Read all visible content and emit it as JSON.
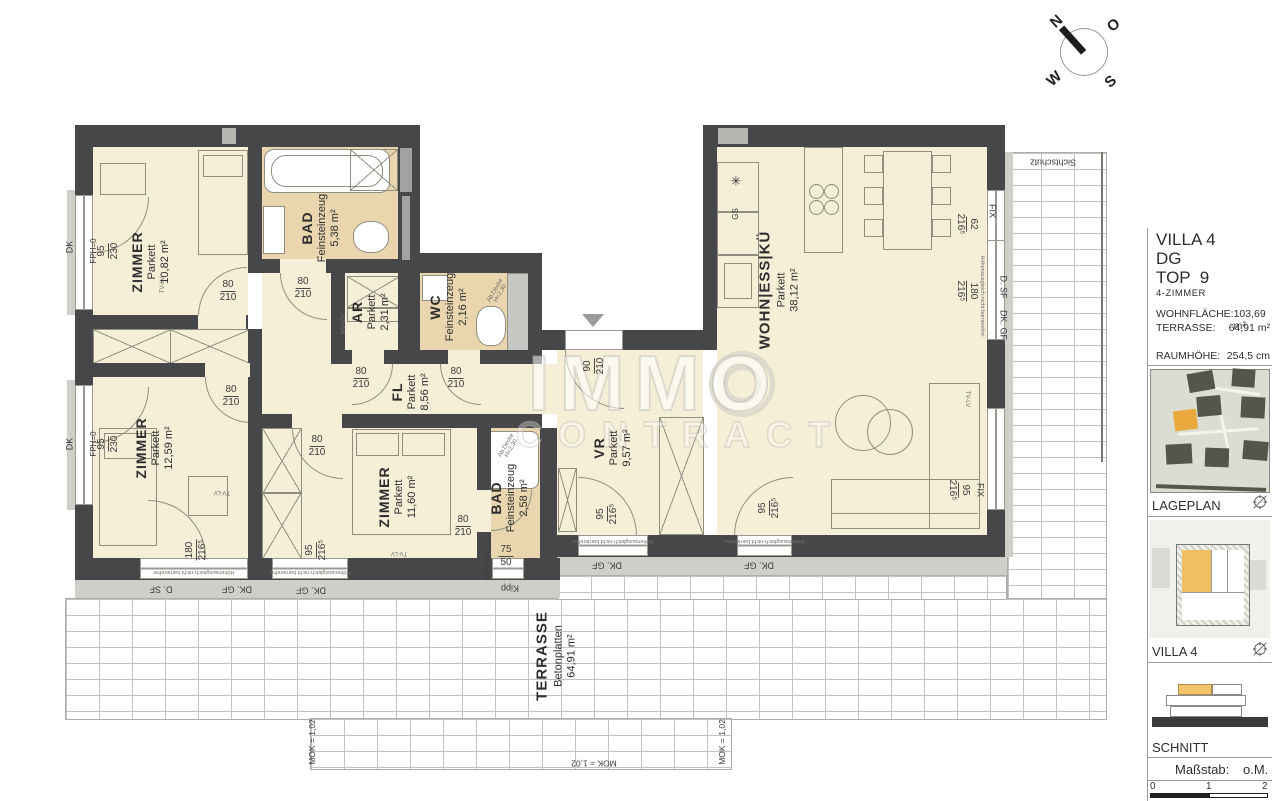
{
  "compass": {
    "n": "N",
    "e": "O",
    "s": "S",
    "w": "W"
  },
  "watermark": {
    "line1": "IMMO",
    "line2": "CONTRACT"
  },
  "rooms": {
    "zimmer1": {
      "name": "ZIMMER",
      "floor": "Parkett",
      "area": "10,82 m²"
    },
    "bad1": {
      "name": "BAD",
      "floor": "Feinsteinzeug",
      "area": "5,38 m²"
    },
    "ar": {
      "name": "AR",
      "floor": "Parkett",
      "area": "2,31 m²"
    },
    "wc": {
      "name": "WC",
      "floor": "Feinsteinzeug",
      "area": "2,16 m²"
    },
    "fl": {
      "name": "FL",
      "floor": "Parkett",
      "area": "8,56 m²"
    },
    "zimmer2": {
      "name": "ZIMMER",
      "floor": "Parkett",
      "area": "12,59 m²"
    },
    "zimmer3": {
      "name": "ZIMMER",
      "floor": "Parkett",
      "area": "11,60 m²"
    },
    "bad2": {
      "name": "BAD",
      "floor": "Feinsteinzeug",
      "area": "2,58 m²"
    },
    "vr": {
      "name": "VR",
      "floor": "Parkett",
      "area": "9,57 m²"
    },
    "wohn": {
      "name": "WOHN|ESS|KÜ",
      "floor": "Parkett",
      "area": "38,12 m²"
    },
    "terrasse": {
      "name": "TERRASSE",
      "floor": "Betonplatten",
      "area": "64,91 m²"
    }
  },
  "dims": {
    "d80": {
      "a": "80",
      "b": "210"
    },
    "d90": {
      "a": "90",
      "b": "210"
    },
    "w95_230": {
      "a": "95",
      "b": "230"
    },
    "w95_216": {
      "a": "95",
      "b": "216⁵"
    },
    "w180_216": {
      "a": "180",
      "b": "216⁵"
    },
    "w62_216": {
      "a": "62",
      "b": "216⁵"
    },
    "w75_50": {
      "a": "75",
      "b": "50"
    }
  },
  "tags": {
    "fix": "FIX",
    "dsf": "D. SF",
    "dkgf": "DK. GF",
    "dk": "DK",
    "kipp": "Kipp",
    "fph0": "FPH=0",
    "fph172": "FPH=172",
    "gs": "GS",
    "freezer": "✳",
    "sichtschutz": "Sichtschutz",
    "mok": "MOK = 1,02",
    "barrier": "Höhenausgleich-nicht barrierefrei",
    "tvlv": "TV-LV",
    "mvev": "MV+EV",
    "abdecke_l1": "Ab.Decke",
    "abdecke_l2": "H=2,30"
  },
  "sidebar": {
    "project": "VILLA 4",
    "floor": "DG",
    "unit": "TOP  9",
    "type": "4-ZIMMER",
    "stats": [
      {
        "label": "WOHNFLÄCHE:",
        "value": "103,69 m²"
      },
      {
        "label": "TERRASSE:",
        "value": "64,91 m²"
      },
      {
        "label": "RAUMHÖHE:",
        "value": "254,5 cm"
      }
    ],
    "sections": {
      "lageplan": "LAGEPLAN",
      "villa": "VILLA 4",
      "schnitt": "SCHNITT"
    },
    "masstab_label": "Maßstab:",
    "masstab_value": "o.M.",
    "scale": {
      "t0": "0",
      "t1": "1",
      "t2": "2"
    }
  }
}
